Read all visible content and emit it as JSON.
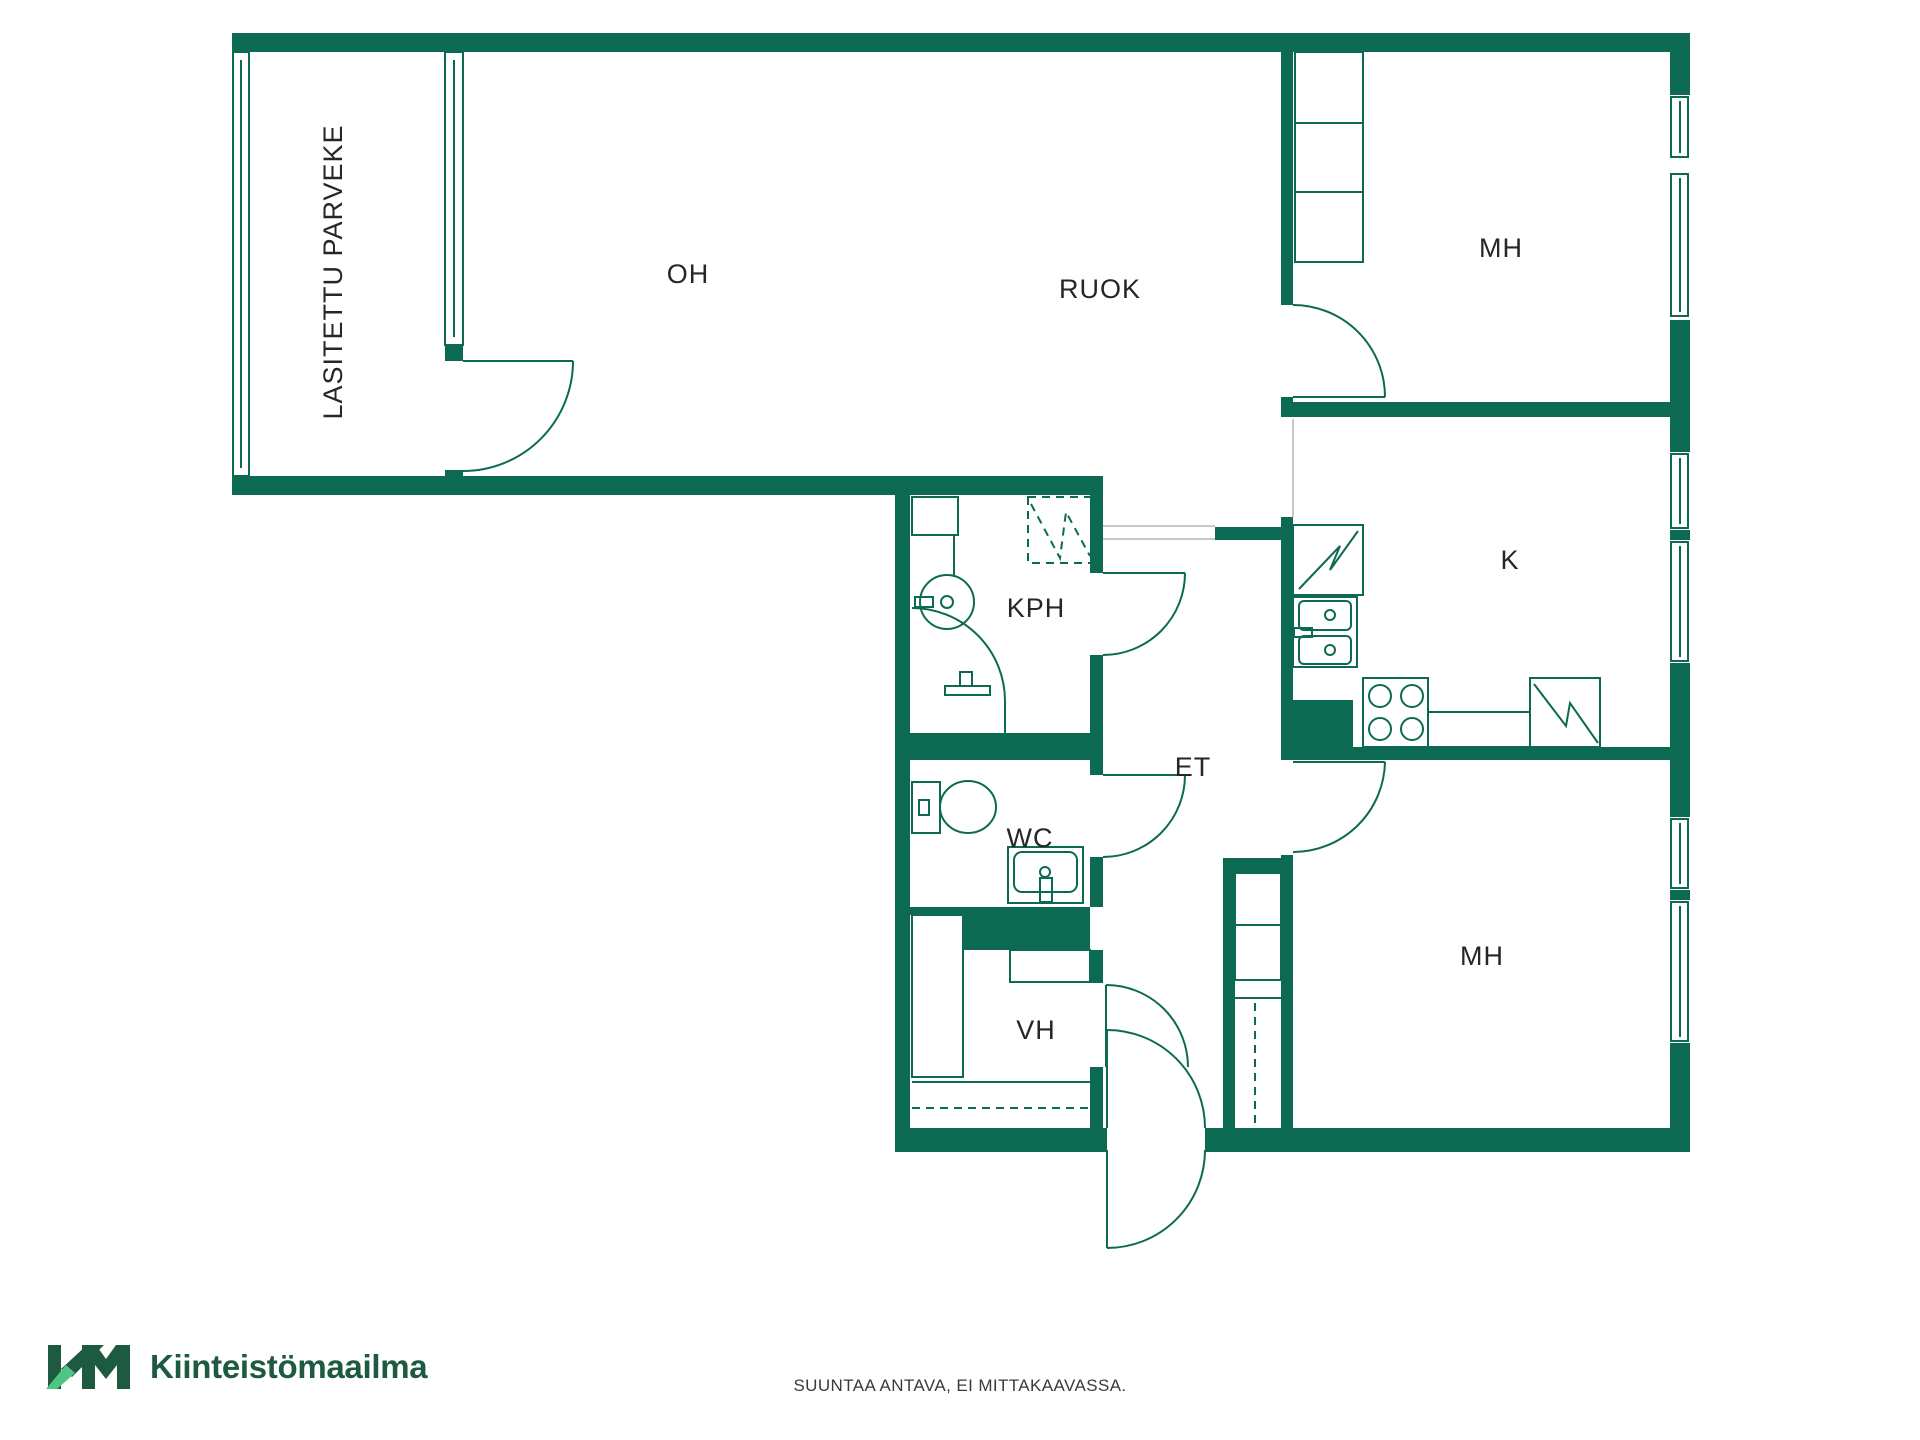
{
  "logo": {
    "name": "Kiinteistömaailma",
    "mark": "KM",
    "color_dark": "#1d5a41",
    "color_light": "#4ec583"
  },
  "footer": {
    "disclaimer": "SUUNTAA ANTAVA, EI MITTAKAAVASSA."
  },
  "colors": {
    "wall": "#0c6a53",
    "line": "#0c6a53",
    "gray": "#c4c9c9",
    "text": "#262626"
  },
  "plan": {
    "width": 1920,
    "height": 1440,
    "labels": [
      {
        "id": "oh",
        "text": "OH",
        "x": 688,
        "y": 274
      },
      {
        "id": "ruok",
        "text": "RUOK",
        "x": 1100,
        "y": 289
      },
      {
        "id": "mh-top",
        "text": "MH",
        "x": 1501,
        "y": 248
      },
      {
        "id": "k",
        "text": "K",
        "x": 1510,
        "y": 560
      },
      {
        "id": "kph",
        "text": "KPH",
        "x": 1036,
        "y": 608
      },
      {
        "id": "et",
        "text": "ET",
        "x": 1193,
        "y": 767
      },
      {
        "id": "wc",
        "text": "WC",
        "x": 1030,
        "y": 838
      },
      {
        "id": "vh",
        "text": "VH",
        "x": 1036,
        "y": 1030
      },
      {
        "id": "mh-bottom",
        "text": "MH",
        "x": 1482,
        "y": 956
      },
      {
        "id": "parveke",
        "text": "LASITETTU PARVEKE",
        "x": 333,
        "y": 272,
        "rot": -90
      }
    ],
    "elements": [
      {
        "t": "rect",
        "f": "wall",
        "r": [
          232,
          33,
          1458,
          19
        ],
        "n": "wall-top"
      },
      {
        "t": "rect",
        "f": "wall",
        "r": [
          1670,
          33,
          20,
          1119
        ],
        "n": "wall-right"
      },
      {
        "t": "rect",
        "f": "wall",
        "r": [
          895,
          1128,
          212,
          24
        ],
        "n": "wall-bottom-left"
      },
      {
        "t": "rect",
        "f": "wall",
        "r": [
          1205,
          1128,
          485,
          24
        ],
        "n": "wall-bottom-right"
      },
      {
        "t": "rect",
        "f": "wall",
        "r": [
          232,
          476,
          871,
          19
        ],
        "n": "wall-oh-south"
      },
      {
        "t": "rect",
        "f": "wall",
        "r": [
          895,
          495,
          15,
          633
        ],
        "n": "wall-mid-left"
      },
      {
        "t": "rect",
        "f": "wall",
        "r": [
          1090,
          495,
          13,
          78
        ],
        "n": "wall-kph-right-upper"
      },
      {
        "t": "rect",
        "f": "wall",
        "r": [
          1090,
          655,
          13,
          78
        ],
        "n": "wall-kph-right-lower"
      },
      {
        "t": "rect",
        "f": "wall",
        "r": [
          910,
          733,
          193,
          27
        ],
        "n": "wall-kph-wc"
      },
      {
        "t": "rect",
        "f": "wall",
        "r": [
          1090,
          760,
          13,
          15
        ],
        "n": "wall-wc-right-upper"
      },
      {
        "t": "rect",
        "f": "wall",
        "r": [
          1090,
          857,
          13,
          50
        ],
        "n": "wall-wc-right-lower"
      },
      {
        "t": "rect",
        "f": "wall",
        "r": [
          910,
          907,
          53,
          8
        ],
        "n": "wall-wc-vh-sliver"
      },
      {
        "t": "rect",
        "f": "wall",
        "r": [
          963,
          907,
          127,
          43
        ],
        "n": "wall-wc-vh"
      },
      {
        "t": "rect",
        "f": "wall",
        "r": [
          1090,
          950,
          13,
          33
        ],
        "n": "wall-vh-right-upper"
      },
      {
        "t": "rect",
        "f": "wall",
        "r": [
          1090,
          1067,
          13,
          61
        ],
        "n": "wall-vh-right-lower"
      },
      {
        "t": "rect",
        "f": "wall",
        "r": [
          1215,
          527,
          78,
          13
        ],
        "n": "wall-et-stub"
      },
      {
        "t": "rect",
        "f": "wall",
        "r": [
          1281,
          517,
          12,
          183
        ],
        "n": "wall-kitchen-left"
      },
      {
        "t": "rect",
        "f": "wall",
        "r": [
          1281,
          700,
          72,
          60
        ],
        "n": "wall-kitchen-chunk"
      },
      {
        "t": "rect",
        "f": "wall",
        "r": [
          1353,
          747,
          317,
          13
        ],
        "n": "wall-kitchen-mh"
      },
      {
        "t": "rect",
        "f": "wall",
        "r": [
          1281,
          855,
          12,
          273
        ],
        "n": "wall-mh-bottom-left"
      },
      {
        "t": "rect",
        "f": "wall",
        "r": [
          1223,
          858,
          58,
          15
        ],
        "n": "wall-closet-top"
      },
      {
        "t": "rect",
        "f": "wall",
        "r": [
          1223,
          858,
          12,
          270
        ],
        "n": "wall-closet-left"
      },
      {
        "t": "rect",
        "f": "wall",
        "r": [
          1281,
          33,
          12,
          272
        ],
        "n": "wall-mh-top-left"
      },
      {
        "t": "rect",
        "f": "wall",
        "r": [
          1281,
          397,
          12,
          20
        ],
        "n": "wall-mh-top-left-stub"
      },
      {
        "t": "rect",
        "f": "wall",
        "r": [
          1281,
          402,
          409,
          15
        ],
        "n": "wall-mh-top-kitchen"
      },
      {
        "t": "rect",
        "f": "wall",
        "r": [
          445,
          345,
          18,
          16
        ],
        "n": "wall-balcony-mullion"
      },
      {
        "t": "rect",
        "f": "wall",
        "r": [
          445,
          470,
          18,
          8
        ],
        "n": "wall-balcony-stub"
      },
      {
        "t": "line",
        "g": 1,
        "p": [
          1293,
          419,
          1293,
          517
        ],
        "n": "boundary-kitchen-line"
      },
      {
        "t": "line",
        "g": 1,
        "p": [
          1103,
          526,
          1215,
          526
        ],
        "n": "boundary-hall-line"
      },
      {
        "t": "line",
        "g": 1,
        "p": [
          1103,
          539,
          1215,
          539
        ],
        "n": "boundary-hall-line"
      },
      {
        "t": "rect",
        "f": "white",
        "r": [
          1670,
          95,
          20,
          225
        ],
        "n": "window-opening"
      },
      {
        "t": "box",
        "f": "white",
        "r": [
          1671,
          97,
          17,
          60
        ],
        "n": "window-glass"
      },
      {
        "t": "box",
        "f": "white",
        "r": [
          1671,
          174,
          17,
          142
        ],
        "n": "window-glass"
      },
      {
        "t": "line",
        "p": [
          1680,
          101,
          1680,
          153
        ],
        "n": "window-glass-line"
      },
      {
        "t": "line",
        "p": [
          1680,
          178,
          1680,
          312
        ],
        "n": "window-glass-line"
      },
      {
        "t": "rect",
        "f": "white",
        "r": [
          1670,
          452,
          20,
          211
        ],
        "n": "window-opening"
      },
      {
        "t": "box",
        "f": "white",
        "r": [
          1671,
          454,
          17,
          74
        ],
        "n": "window-glass"
      },
      {
        "t": "box",
        "f": "white",
        "r": [
          1671,
          542,
          17,
          119
        ],
        "n": "window-glass"
      },
      {
        "t": "line",
        "p": [
          1680,
          458,
          1680,
          524
        ],
        "n": "window-glass-line"
      },
      {
        "t": "line",
        "p": [
          1680,
          546,
          1680,
          657
        ],
        "n": "window-glass-line"
      },
      {
        "t": "rect",
        "f": "wall",
        "r": [
          1670,
          530,
          20,
          10
        ],
        "n": "window-mullion"
      },
      {
        "t": "rect",
        "f": "white",
        "r": [
          1670,
          817,
          20,
          226
        ],
        "n": "window-opening"
      },
      {
        "t": "box",
        "f": "white",
        "r": [
          1671,
          819,
          17,
          69
        ],
        "n": "window-glass"
      },
      {
        "t": "box",
        "f": "white",
        "r": [
          1671,
          902,
          17,
          139
        ],
        "n": "window-glass"
      },
      {
        "t": "line",
        "p": [
          1680,
          823,
          1680,
          884
        ],
        "n": "window-glass-line"
      },
      {
        "t": "line",
        "p": [
          1680,
          906,
          1680,
          1037
        ],
        "n": "window-glass-line"
      },
      {
        "t": "rect",
        "f": "wall",
        "r": [
          1670,
          890,
          20,
          10
        ],
        "n": "window-mullion"
      },
      {
        "t": "box",
        "r": [
          233,
          52,
          16,
          424
        ],
        "n": "balcony-glazing-left"
      },
      {
        "t": "line",
        "p": [
          241,
          60,
          241,
          468
        ],
        "n": "balcony-glazing-line"
      },
      {
        "t": "box",
        "r": [
          445,
          52,
          18,
          293
        ],
        "n": "balcony-glazing-partition"
      },
      {
        "t": "line",
        "p": [
          454,
          60,
          454,
          337
        ],
        "n": "balcony-glazing-line"
      },
      {
        "t": "box",
        "r": [
          912,
          497,
          46,
          38
        ],
        "n": "bathroom-cabinet-icon"
      },
      {
        "t": "line",
        "p": [
          954,
          535,
          954,
          577
        ],
        "n": "bathroom-counter-line"
      },
      {
        "t": "circle",
        "c": [
          947,
          602,
          27
        ],
        "n": "washing-machine-icon"
      },
      {
        "t": "circle",
        "c": [
          947,
          602,
          6
        ],
        "n": "washing-machine-icon"
      },
      {
        "t": "box",
        "r": [
          915,
          597,
          18,
          10
        ],
        "n": "washing-machine-detail"
      },
      {
        "t": "path",
        "d": "M 912 608 A 93 93 0 0 1 1005 701",
        "n": "shower-screen-icon"
      },
      {
        "t": "line",
        "p": [
          1005,
          701,
          1005,
          733
        ],
        "n": "shower-screen-icon"
      },
      {
        "t": "box",
        "r": [
          945,
          686,
          45,
          9
        ],
        "n": "shower-faucet-icon"
      },
      {
        "t": "box",
        "r": [
          960,
          672,
          12,
          14
        ],
        "n": "shower-faucet-icon"
      },
      {
        "t": "box",
        "ds": 1,
        "r": [
          1028,
          497,
          64,
          66
        ],
        "n": "shower-area-dashed"
      },
      {
        "t": "path",
        "ds": 1,
        "d": "M 1031 504 L 1060 558 L 1066 512 L 1090 556",
        "n": "shower-area-dashed"
      },
      {
        "t": "box",
        "r": [
          912,
          782,
          28,
          51
        ],
        "n": "toilet-icon"
      },
      {
        "t": "ellipse",
        "c": [
          968,
          807,
          28,
          26
        ],
        "n": "toilet-icon"
      },
      {
        "t": "box",
        "r": [
          919,
          800,
          10,
          15
        ],
        "n": "toilet-icon"
      },
      {
        "t": "box",
        "r": [
          1008,
          847,
          75,
          56
        ],
        "n": "sink-icon"
      },
      {
        "t": "box",
        "rx": 8,
        "r": [
          1014,
          852,
          63,
          40
        ],
        "n": "sink-icon"
      },
      {
        "t": "circle",
        "c": [
          1045,
          872,
          5
        ],
        "n": "sink-faucet-icon"
      },
      {
        "t": "box",
        "r": [
          1040,
          878,
          12,
          24
        ],
        "n": "sink-faucet-icon"
      },
      {
        "t": "box",
        "r": [
          912,
          915,
          51,
          162
        ],
        "n": "vh-closet-icon"
      },
      {
        "t": "box",
        "r": [
          1010,
          950,
          80,
          32
        ],
        "n": "vh-shelf-icon"
      },
      {
        "t": "line",
        "p": [
          912,
          1082,
          1090,
          1082
        ],
        "n": "vh-shelf-line"
      },
      {
        "t": "line",
        "ds": 1,
        "p": [
          912,
          1108,
          1090,
          1108
        ],
        "n": "vh-rail-dashed"
      },
      {
        "t": "box",
        "r": [
          1235,
          873,
          46,
          52
        ],
        "n": "hall-closet-icon"
      },
      {
        "t": "box",
        "r": [
          1235,
          925,
          46,
          55
        ],
        "n": "hall-closet-icon"
      },
      {
        "t": "line",
        "p": [
          1235,
          998,
          1281,
          998
        ],
        "n": "hall-closet-shelf"
      },
      {
        "t": "line",
        "ds": 1,
        "p": [
          1255,
          1003,
          1255,
          1125
        ],
        "n": "hall-closet-rail"
      },
      {
        "t": "box",
        "r": [
          1293,
          525,
          70,
          70
        ],
        "n": "fridge-icon"
      },
      {
        "t": "path",
        "d": "M 1299 589 L 1340 546 L 1330 570 L 1358 531",
        "n": "fridge-icon"
      },
      {
        "t": "box",
        "r": [
          1293,
          597,
          64,
          70
        ],
        "n": "kitchen-sink-icon"
      },
      {
        "t": "box",
        "rx": 5,
        "r": [
          1299,
          601,
          52,
          29
        ],
        "n": "kitchen-sink-icon"
      },
      {
        "t": "box",
        "rx": 5,
        "r": [
          1299,
          636,
          52,
          28
        ],
        "n": "kitchen-sink-icon"
      },
      {
        "t": "circle",
        "c": [
          1330,
          615,
          5
        ],
        "n": "kitchen-sink-icon"
      },
      {
        "t": "circle",
        "c": [
          1330,
          650,
          5
        ],
        "n": "kitchen-sink-icon"
      },
      {
        "t": "box",
        "r": [
          1294,
          628,
          18,
          9
        ],
        "n": "kitchen-tap-icon"
      },
      {
        "t": "box",
        "r": [
          1363,
          678,
          65,
          69
        ],
        "n": "stove-icon"
      },
      {
        "t": "circle",
        "c": [
          1380,
          696,
          11
        ],
        "n": "stove-burner-icon"
      },
      {
        "t": "circle",
        "c": [
          1412,
          696,
          11
        ],
        "n": "stove-burner-icon"
      },
      {
        "t": "circle",
        "c": [
          1380,
          729,
          11
        ],
        "n": "stove-burner-icon"
      },
      {
        "t": "circle",
        "c": [
          1412,
          729,
          11
        ],
        "n": "stove-burner-icon"
      },
      {
        "t": "box",
        "r": [
          1428,
          712,
          102,
          35
        ],
        "n": "counter-icon"
      },
      {
        "t": "box",
        "r": [
          1530,
          678,
          70,
          69
        ],
        "n": "dishwasher-icon"
      },
      {
        "t": "path",
        "d": "M 1534 684 L 1566 726 L 1570 703 L 1598 743",
        "n": "dishwasher-icon"
      },
      {
        "t": "box",
        "r": [
          1295,
          52,
          68,
          71
        ],
        "n": "wardrobe-icon"
      },
      {
        "t": "box",
        "r": [
          1295,
          123,
          68,
          69
        ],
        "n": "wardrobe-icon"
      },
      {
        "t": "box",
        "r": [
          1295,
          192,
          68,
          70
        ],
        "n": "wardrobe-icon"
      },
      {
        "t": "door",
        "h": [
          463,
          361
        ],
        "tip": [
          573,
          361
        ],
        "end": [
          463,
          471
        ],
        "n": "door-balcony"
      },
      {
        "t": "door",
        "h": [
          1293,
          397
        ],
        "tip": [
          1385,
          397
        ],
        "end": [
          1293,
          305
        ],
        "n": "door-bedroom-top"
      },
      {
        "t": "door",
        "h": [
          1103,
          573
        ],
        "tip": [
          1185,
          573
        ],
        "end": [
          1103,
          655
        ],
        "n": "door-bathroom"
      },
      {
        "t": "door",
        "h": [
          1103,
          775
        ],
        "tip": [
          1185,
          775
        ],
        "end": [
          1103,
          857
        ],
        "n": "door-wc"
      },
      {
        "t": "door",
        "h": [
          1106,
          1067
        ],
        "tip": [
          1106,
          985
        ],
        "end": [
          1188,
          1067
        ],
        "n": "door-vh"
      },
      {
        "t": "door",
        "h": [
          1293,
          762
        ],
        "tip": [
          1385,
          762
        ],
        "end": [
          1293,
          852
        ],
        "n": "door-bedroom-bottom"
      },
      {
        "t": "door",
        "h": [
          1107,
          1128
        ],
        "tip": [
          1107,
          1030
        ],
        "end": [
          1205,
          1128
        ],
        "n": "door-entry-inner"
      },
      {
        "t": "door",
        "h": [
          1107,
          1150
        ],
        "tip": [
          1107,
          1248
        ],
        "end": [
          1205,
          1150
        ],
        "n": "door-entry-outer"
      }
    ]
  }
}
